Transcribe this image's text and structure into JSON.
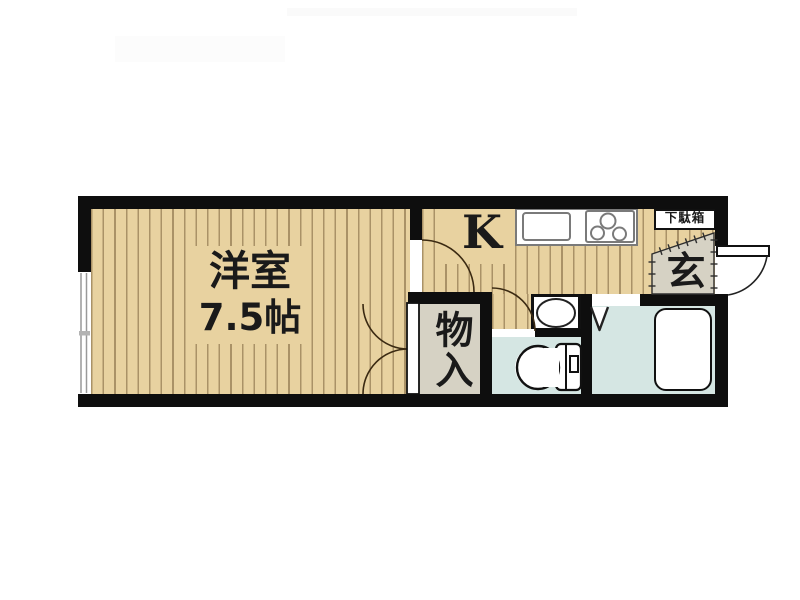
{
  "plan": {
    "type": "japanese-apartment-floor-plan",
    "rooms": {
      "living": {
        "name": "洋室",
        "size": "7.5帖"
      },
      "kitchen": {
        "label": "K"
      },
      "closet": {
        "label": "物入"
      },
      "entrance": {
        "label": "玄"
      },
      "shoe_cabinet": {
        "label": "下駄箱"
      }
    },
    "fixtures": [
      "window-icon",
      "kitchen-sink-icon",
      "gas-stove-icon",
      "wash-basin-icon",
      "toilet-icon",
      "bathtub-icon",
      "entrance-door-icon",
      "folding-door-icon",
      "hinged-door-icon",
      "double-closet-door-icon"
    ],
    "colors": {
      "wall": "#0e0e0e",
      "wood_floor": "#e8d2a0",
      "wood_stripe": "#765e38",
      "tile_gray": "#d6d2c4",
      "wet_area_blue": "#d5e6e3",
      "door_arc": "#3b2a12",
      "background": "#ffffff"
    }
  }
}
